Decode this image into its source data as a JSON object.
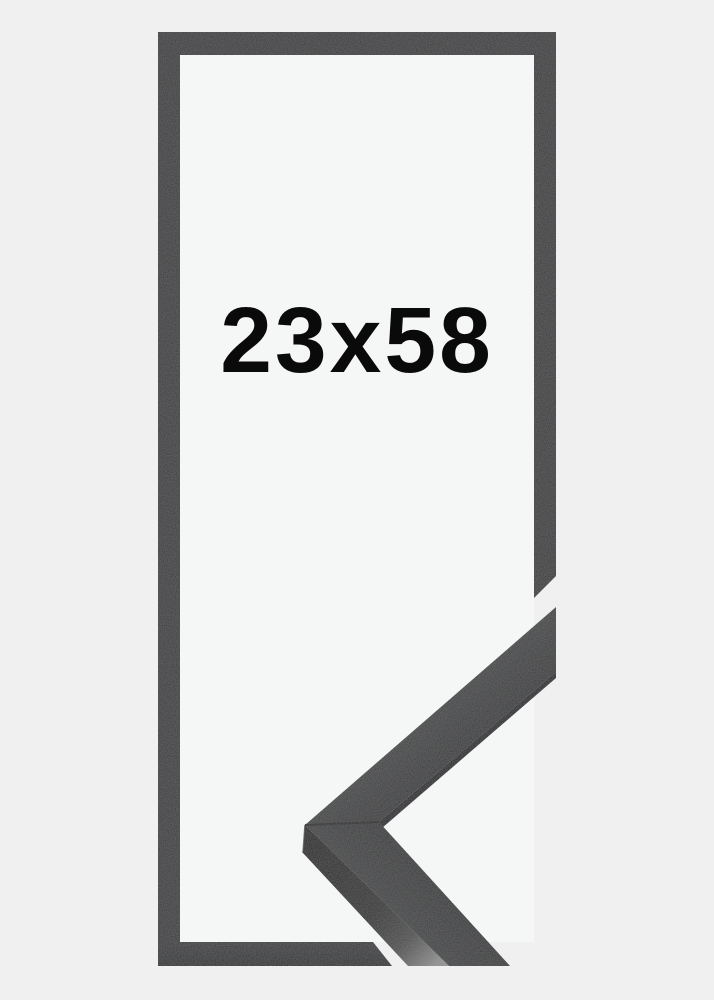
{
  "product_image": {
    "size_label": "23x58"
  },
  "colors": {
    "background": "#f0f0f0",
    "inner_background": "#f5f6f6",
    "frame_outline": "#353639",
    "frame_outline_dark": "#28292b",
    "moulding_face_light": "#3e3f41",
    "moulding_face_dark": "#2d2e30",
    "moulding_face_light2": "#3c3d3f",
    "moulding_face_dark2": "#2e2f31",
    "moulding_lip": "#1e1f20",
    "moulding_side_dark": "#1c1c1c",
    "moulding_side_mid": "#2b2b2b",
    "moulding_side_mid2": "#4a4a4a",
    "moulding_side_light": "#8f8f8f",
    "miter_seam": "#1a1a1a",
    "label_text": "#0a0a0a"
  }
}
